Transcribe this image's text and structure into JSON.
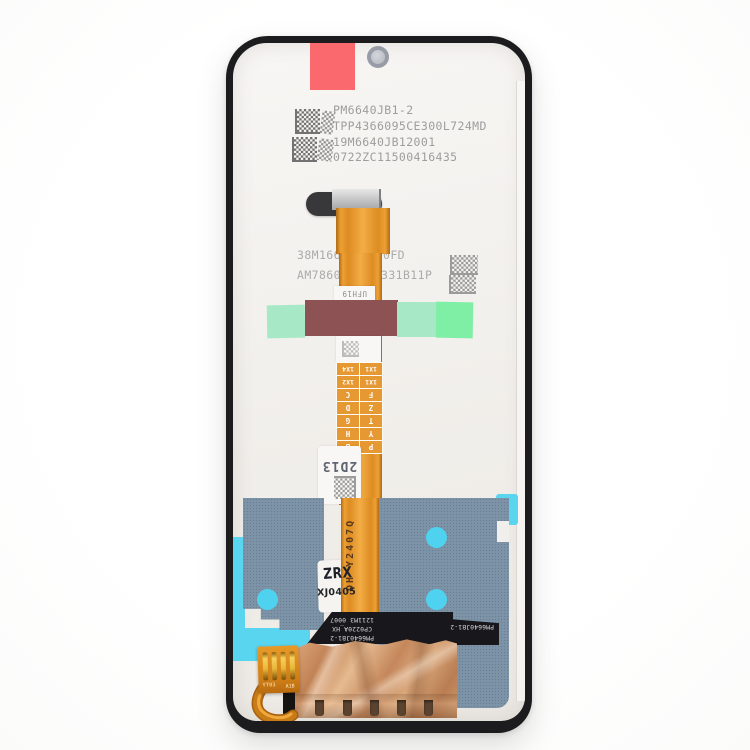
{
  "product_photo": {
    "description_tag": "lcd-screen-assembly-back",
    "top_codes": [
      "PM6640JB1-2",
      "TPP4366095CE300L724MD",
      "19M6640JB12001",
      "0722ZC11500416435"
    ],
    "mid_codes": {
      "l1a": "38M166",
      "l1b": "0FD",
      "l2a": "AM7860",
      "l2b": "331B11P"
    },
    "ufh": "UFH19",
    "grid": [
      [
        "P",
        "B"
      ],
      [
        "Y",
        "H"
      ],
      [
        "T",
        "G"
      ],
      [
        "Z",
        "D"
      ],
      [
        "F",
        "C"
      ],
      [
        "1X1",
        "1X2"
      ],
      [
        "1X1",
        "1X4"
      ]
    ],
    "code2d13": "2D13",
    "flex_print": "DH Y2407Q",
    "stamp1": "ZRX",
    "stamp2": "XJ0405",
    "black_lines": [
      "PM6640JB1-2",
      "CP0220A_HX",
      "1211M3 0007"
    ],
    "black_right": "PM6640JB1-2",
    "pad_a": "YT03",
    "pad_b": "A1B"
  },
  "colors": {
    "frame_black": "#1c1c1e",
    "panel_offwhite": "#f2f0ec",
    "sticker_red": "#f9696e",
    "flex_orange": "#e8962e",
    "tape_green_pale": "#a7e9c7",
    "tape_green_bright": "#7fefa5",
    "tape_maroon": "#8d5253",
    "graphite_blue": "#7d94a8",
    "adhesive_cyan": "#59d5f0",
    "copper_foil": "#c98e63",
    "black_flex": "#18171b",
    "print_gray": "#9d9d9d"
  }
}
